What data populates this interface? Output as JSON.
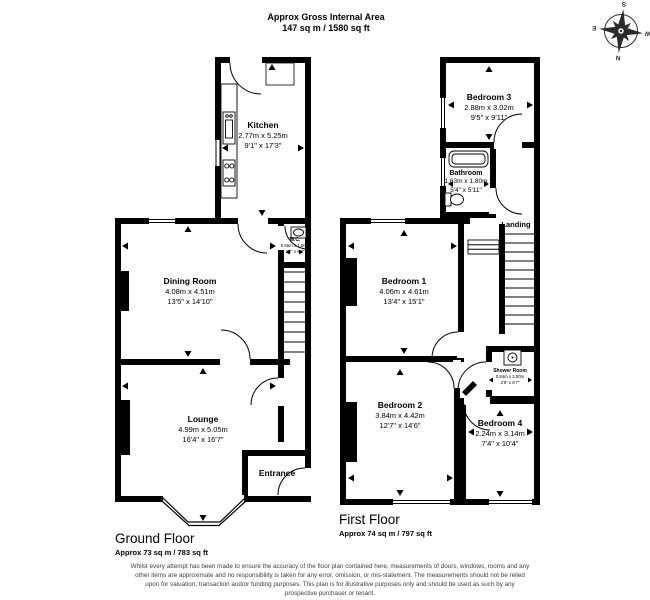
{
  "header": {
    "title": "Approx Gross Internal Area",
    "subtitle": "147 sq m / 1580 sq ft"
  },
  "compass": {
    "n": "N",
    "e": "E",
    "s": "S",
    "w": "W"
  },
  "colors": {
    "walls": "#000000",
    "background": "#ffffff",
    "disclaimer_text": "#3c3c3c"
  },
  "icons": {
    "compass": "compass-rose",
    "bathtub": "bathtub-icon",
    "toilet": "toilet-icon",
    "shower": "shower-icon",
    "basin": "basin-icon",
    "sink": "sink-icon",
    "stove": "stove-icon",
    "stairs": "stairs-icon"
  },
  "ground_floor": {
    "heading": "Ground Floor",
    "area": "Approx 73 sq m / 783 sq ft",
    "rooms": {
      "kitchen": {
        "name": "Kitchen",
        "metric": "2.77m x 5.25m",
        "imperial": "9'1\" x 17'3\""
      },
      "dining_room": {
        "name": "Dining Room",
        "metric": "4.08m x 4.51m",
        "imperial": "13'5\" x 14'10\""
      },
      "wc": {
        "name": "W.C.",
        "metric": "0.66m x 1.60m",
        "imperial": "2'2\" x 5'3\""
      },
      "lounge": {
        "name": "Lounge",
        "metric": "4.99m x 5.05m",
        "imperial": "16'4\" x 16'7\""
      },
      "entrance": {
        "name": "Entrance"
      }
    }
  },
  "first_floor": {
    "heading": "First Floor",
    "area": "Approx 74 sq m / 797 sq ft",
    "rooms": {
      "bedroom_3": {
        "name": "Bedroom 3",
        "metric": "2.88m x 3.02m",
        "imperial": "9'5\" x 9'11\""
      },
      "bathroom": {
        "name": "Bathroom",
        "metric": "1.63m x 1.80m",
        "imperial": "5'4\" x 5'11\""
      },
      "landing": {
        "name": "Landing"
      },
      "bedroom_1": {
        "name": "Bedroom 1",
        "metric": "4.06m x 4.61m",
        "imperial": "13'4\" x 15'1\""
      },
      "bedroom_2": {
        "name": "Bedroom 2",
        "metric": "3.84m x 4.42m",
        "imperial": "12'7\" x 14'6\""
      },
      "bedroom_4": {
        "name": "Bedroom 4",
        "metric": "2.24m x 3.14m",
        "imperial": "7'4\" x 10'4\""
      },
      "shower_room": {
        "name": "Shower Room",
        "metric": "0.84m x 2.00m",
        "imperial": "2'9\" x 6'7\""
      }
    }
  },
  "footer": {
    "disclaimer": "Whilst every attempt has been made to ensure the accuracy of the floor plan contained here, measurements of doors, windows, rooms and any other items are approximate and no responsibility is taken for any error, omission, or mis-statement. The measurements should not be relied upon for valuation, transaction and/or funding purposes. This plan is for illustrative purposes only and should be used as such by any prospective purchaser or tenant."
  }
}
